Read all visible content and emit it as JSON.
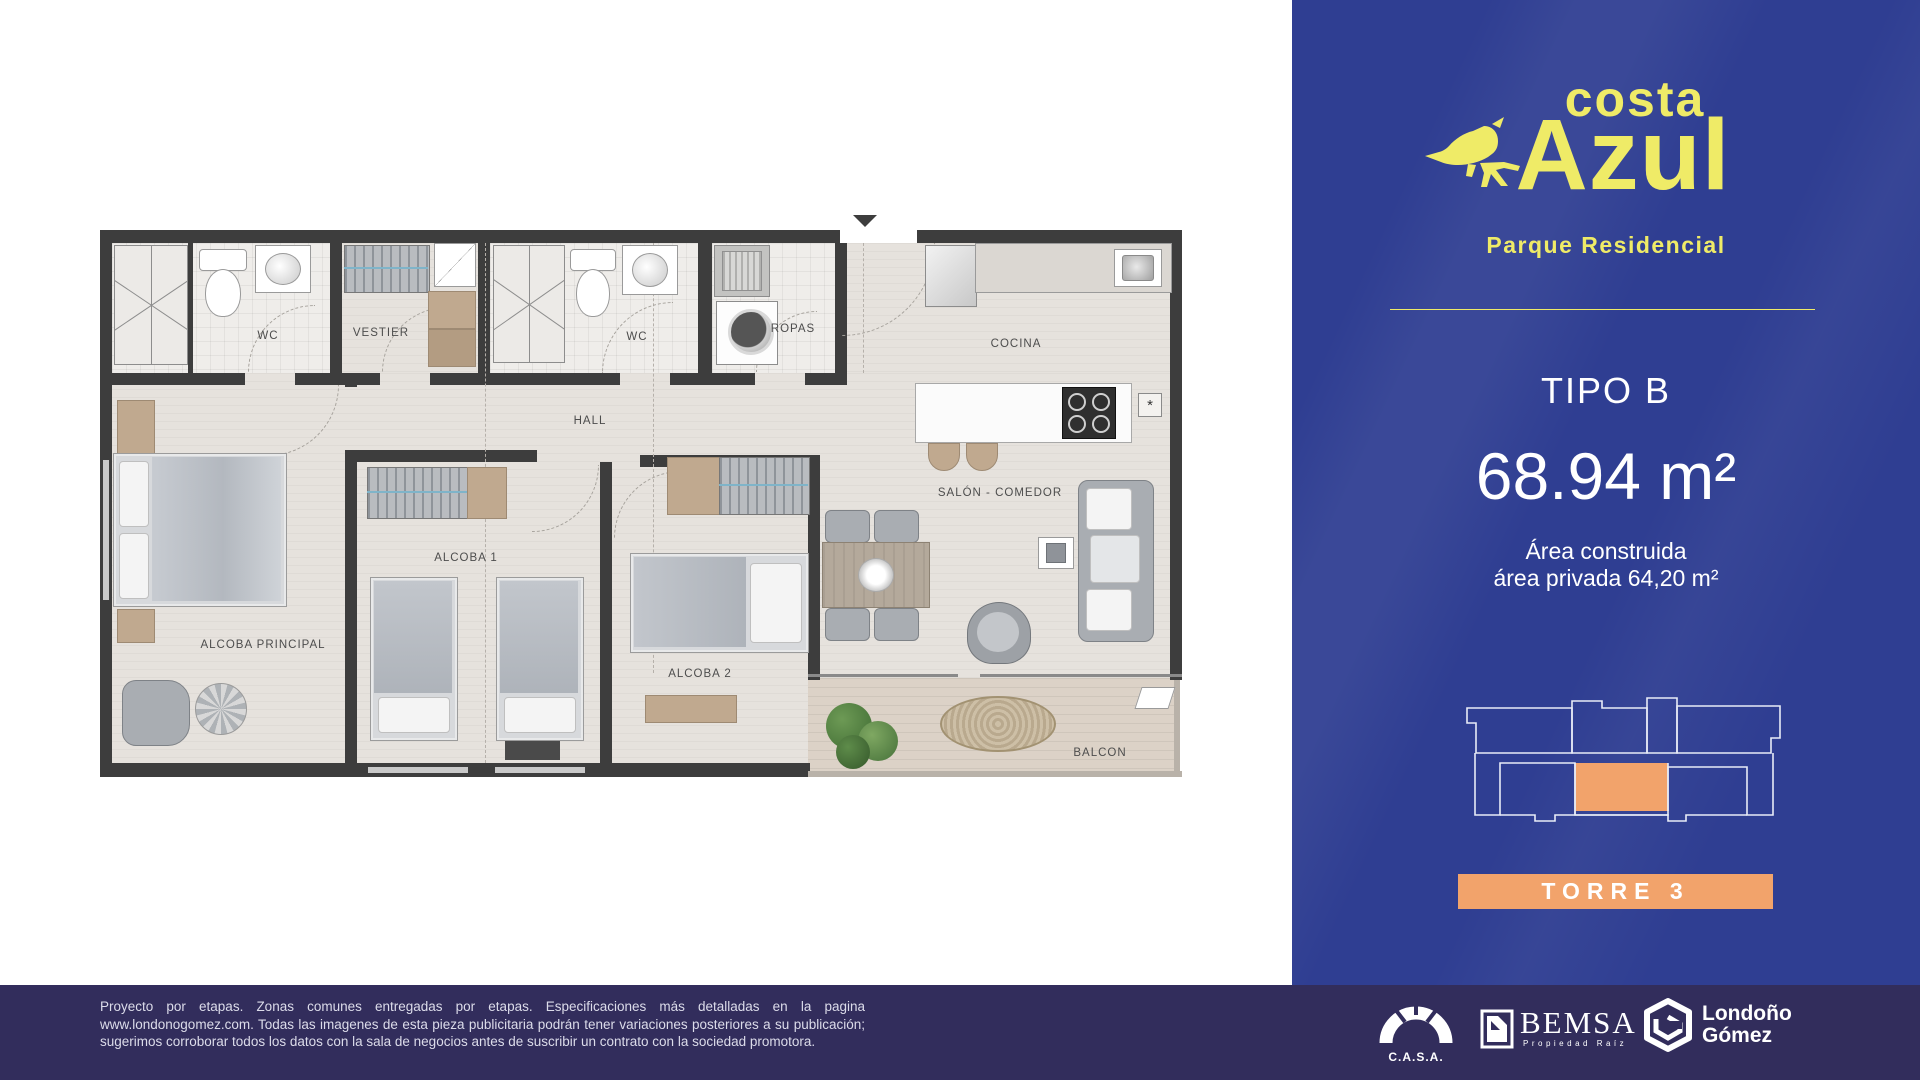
{
  "plan": {
    "rooms": {
      "wc1": "WC",
      "vestier": "VESTIER",
      "wc2": "WC",
      "ropas": "ROPAS",
      "cocina": "COCINA",
      "hall": "HALL",
      "alcoba1": "ALCOBA 1",
      "salon": "SALÓN - COMEDOR",
      "alcoba_principal": "ALCOBA PRINCIPAL",
      "alcoba2": "ALCOBA 2",
      "balcon": "BALCON"
    },
    "kitchen_marker": "*"
  },
  "panel": {
    "bg_color": "#2f3e92",
    "accent_yellow": "#efeb67",
    "unit_highlight_color": "#f2a36b",
    "brand": {
      "line1": "costa",
      "line2": "Azul",
      "subtitle": "Parque Residencial"
    },
    "tipo_label": "TIPO B",
    "area_value": "68.94 m²",
    "area_line1": "Área construida",
    "area_line2": "área privada 64,20 m²",
    "torre_label": "TORRE 3"
  },
  "footer": {
    "bg_color": "#322d5c",
    "disclaimer": "Proyecto por etapas. Zonas comunes entregadas por etapas. Especificaciones más detalladas en la pagina www.londonogomez.com. Todas las imagenes de esta pieza publicitaria podrán tener variaciones posteriores a su publicación; sugerimos corroborar todos los datos con la sala de negocios antes de suscribir un contrato con la sociedad promotora.",
    "logos": {
      "casa": "C.A.S.A.",
      "bemsa": "BEMSA",
      "bemsa_sub": "Propiedad Raíz",
      "lg_line1": "Londoño",
      "lg_line2": "Gómez"
    }
  }
}
